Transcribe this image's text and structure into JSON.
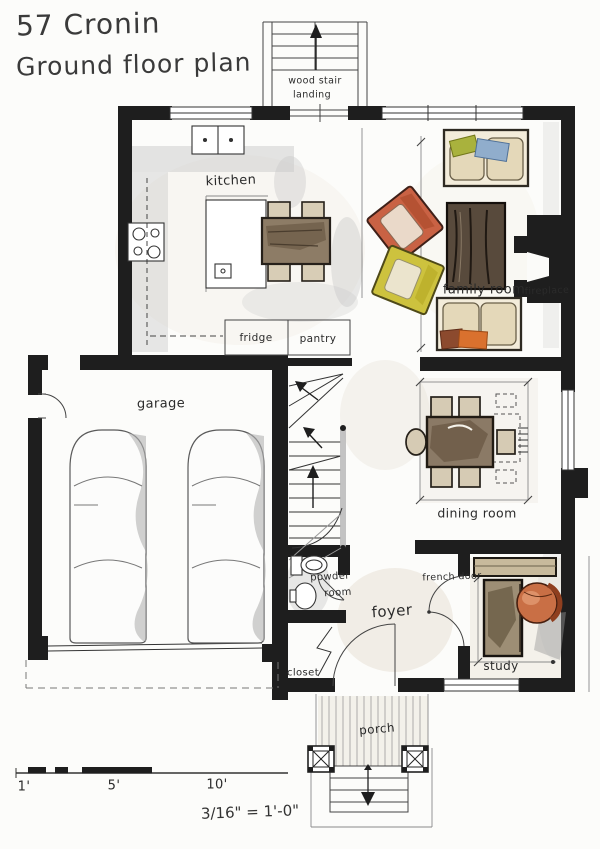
{
  "title": {
    "address": "57 Cronin",
    "subtitle": "Ground floor plan"
  },
  "labels": {
    "kitchen": "kitchen",
    "family_room": "family room",
    "fireplace": "fireplace",
    "fridge": "fridge",
    "pantry": "pantry",
    "garage": "garage",
    "dining_room": "dining room",
    "powder_line1": "powder",
    "powder_line2": "room",
    "foyer": "foyer",
    "french_door": "french door",
    "closet": "closet",
    "study": "study",
    "porch": "porch",
    "stair_line1": "wood stair",
    "stair_line2": "landing"
  },
  "scale_bar": {
    "tick_1ft": "1'",
    "tick_5ft": "5'",
    "tick_10ft": "10'",
    "ratio": "3/16\" = 1'-0\""
  },
  "colors": {
    "wall_black": "#1e1e1e",
    "sofa_beige": "#e4d8b9",
    "pillow_green": "#a9b23d",
    "pillow_blue": "#90adcc",
    "chair_orange": "#c96244",
    "chair_yellow": "#cdc23e",
    "coffee_table_darkwood": "#584a3c",
    "wood_brown": "#8b7a66",
    "wash_gray": "#c9c9c9",
    "wash_beige": "#dcd2bf"
  }
}
